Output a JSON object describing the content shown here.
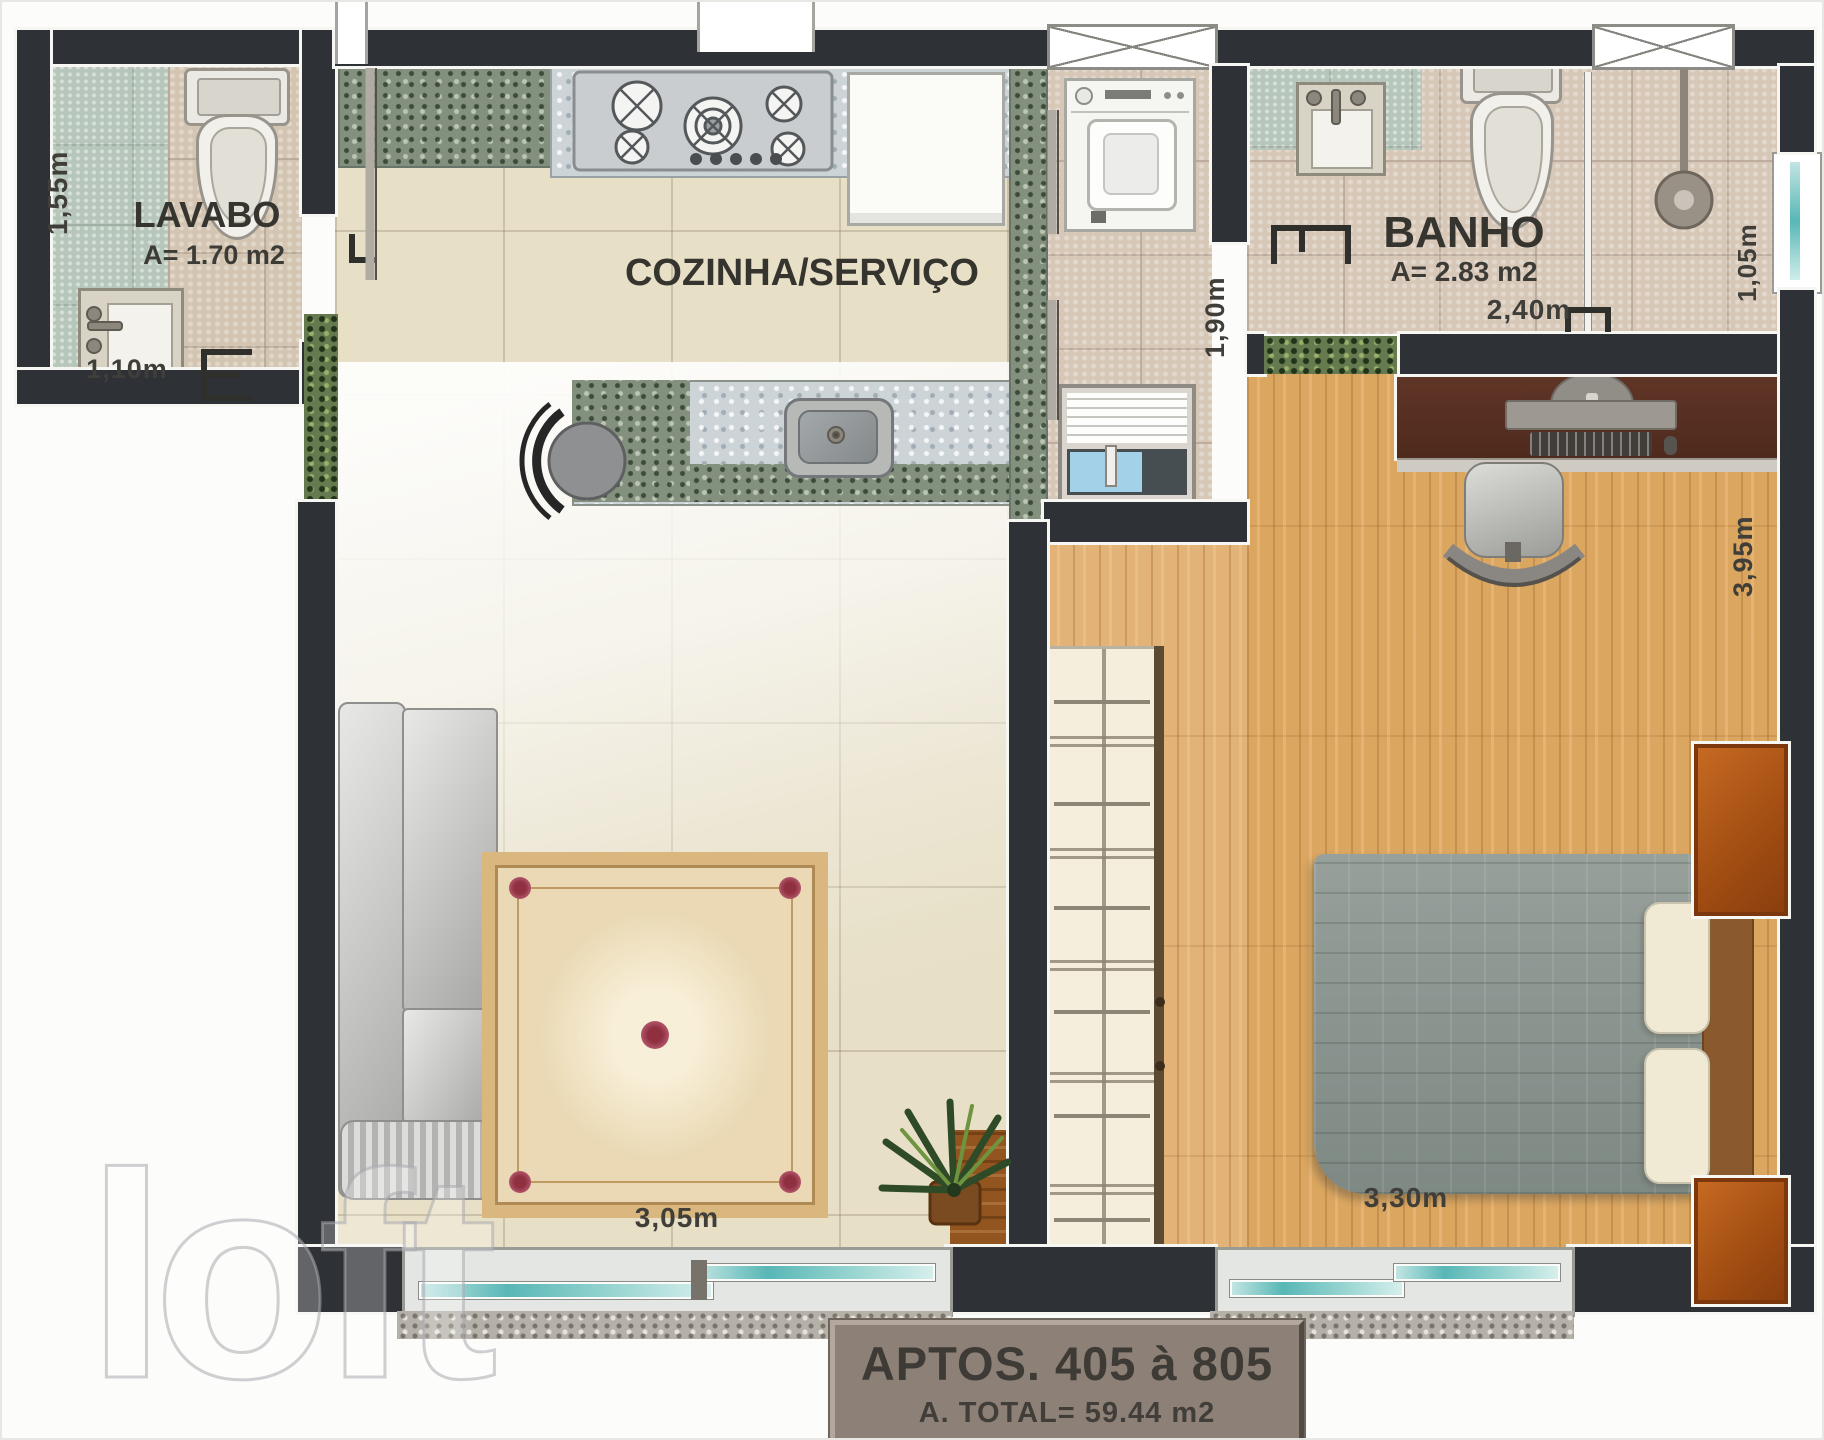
{
  "banner": {
    "title": "APTOS. 405 à 805",
    "subtitle": "A. TOTAL= 59.44 m2"
  },
  "rooms": {
    "lavabo": {
      "label": "LAVABO",
      "area": "A= 1.70 m2"
    },
    "cozinha_servico": {
      "label": "COZINHA/SERVIÇO"
    },
    "banho": {
      "label": "BANHO",
      "area": "A= 2.83 m2"
    }
  },
  "dimensions": {
    "lavabo_depth": "1,55m",
    "lavabo_width": "1,10m",
    "servico_depth": "1,90m",
    "banho_width": "2,40m",
    "banho_shower_width": "1,05m",
    "dormitorio_depth": "3,95m",
    "dormitorio_width": "3,30m",
    "sala_width": "3,05m"
  },
  "watermark": {
    "text": "loft"
  },
  "colors": {
    "wall": "#2e3135",
    "floor_tile": "#e7dfc6",
    "floor_bath": "#d7c7b7",
    "floor_wood": "#dba660",
    "granite_light": "#cdd4d8",
    "granite_dark": "#83907e",
    "window_glass": "#58b7b6",
    "banner_bg": "#8d8177",
    "banner_text": "#3e3a35"
  }
}
